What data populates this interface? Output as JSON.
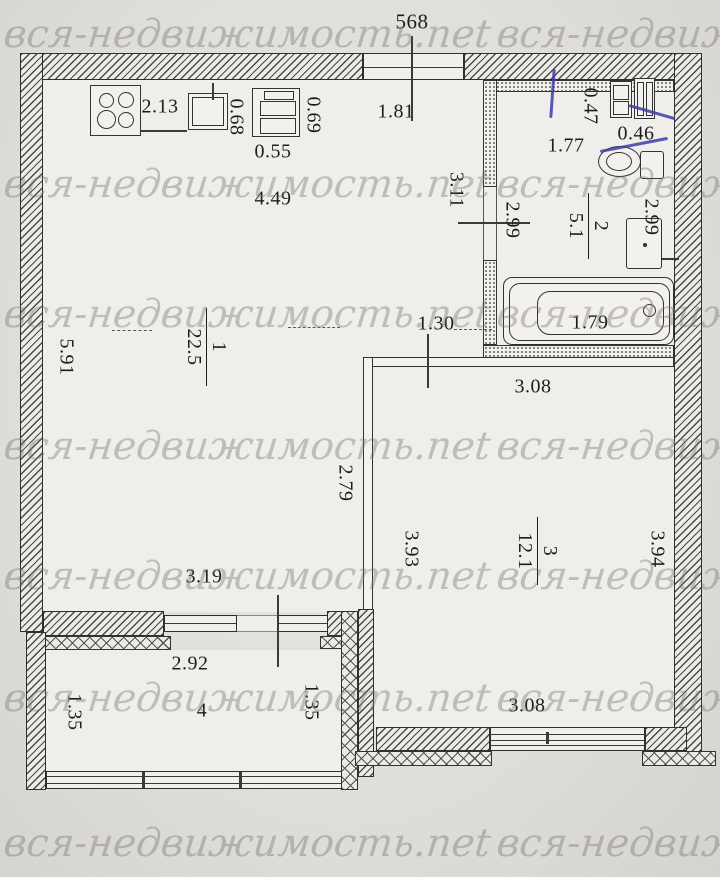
{
  "watermark": {
    "full": "вся-недвижимость.net",
    "partial_right": "вся-недвиж"
  },
  "dims": {
    "overall_top": "568",
    "stove": "2.13",
    "sink": "0.68",
    "cabinet_w": "0.69",
    "cabinet_d": "0.55",
    "top_window": "1.81",
    "room1_width": "4.49",
    "corridor": "3.11",
    "bath_left_depth": "2.99",
    "bath_width": "1.77",
    "washer": "0.47",
    "bath_cabinet": "0.46",
    "bath_right_depth": "2.99",
    "bathtub": "1.79",
    "room1_depth": "5.91",
    "passage": "1.30",
    "room3_top_width": "3.08",
    "partition": "2.79",
    "room3_left_depth": "3.93",
    "room3_right_depth": "3.94",
    "room1_bottom_width": "3.19",
    "balcony_width": "2.92",
    "balcony_left_depth": "1.35",
    "balcony_right_depth": "1.35",
    "room3_bottom_width": "3.08"
  },
  "rooms": {
    "room1": {
      "number": "1",
      "area": "22.5"
    },
    "room2": {
      "number": "2",
      "area": "5.1"
    },
    "room3": {
      "number": "3",
      "area": "12.1"
    },
    "room4": {
      "number": "4"
    }
  },
  "colors": {
    "paper": "#e0deda",
    "floor": "#f0eeea",
    "ink": "#2e2e2e",
    "pen_blue": "#3c3caa",
    "watermark": "#767470"
  }
}
